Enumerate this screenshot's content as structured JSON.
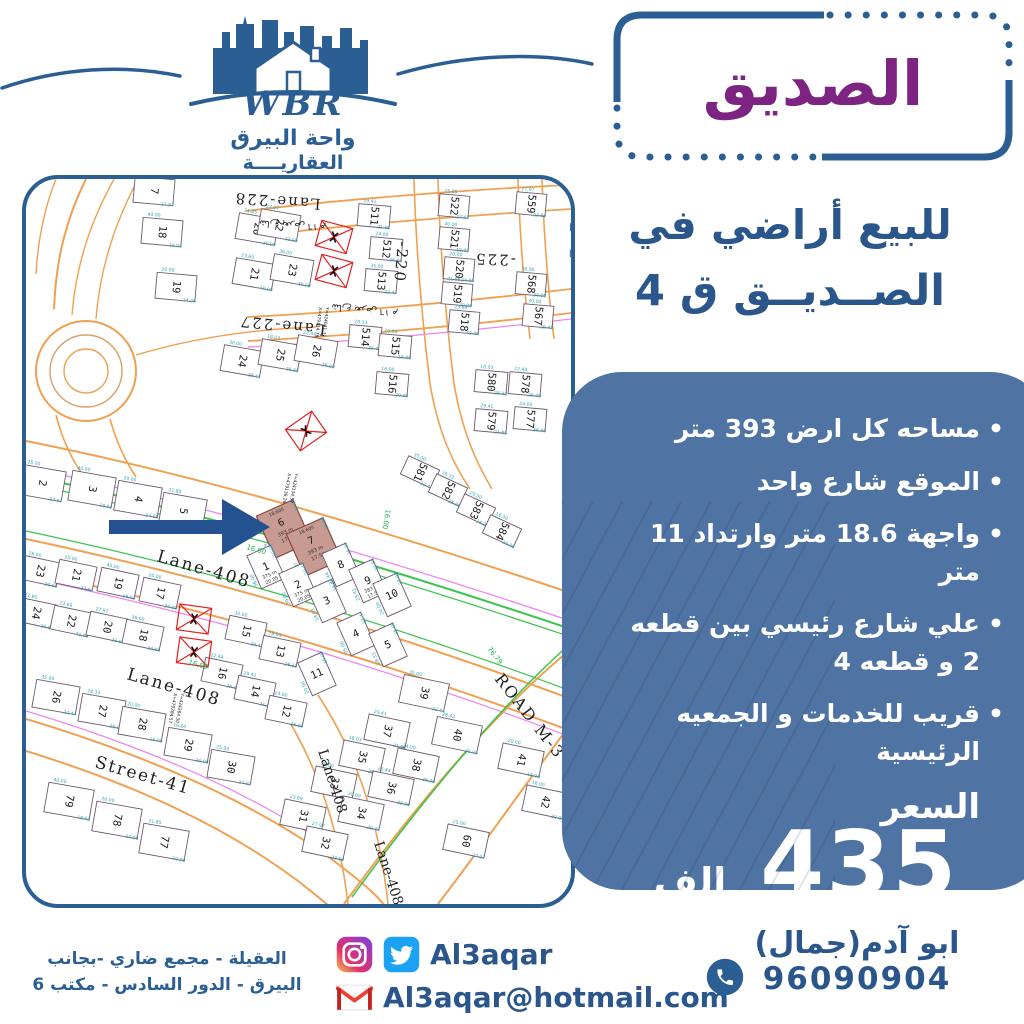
{
  "brand": {
    "name": "WBR",
    "line1": "واحة البيرق",
    "line2": "العقاريــــة"
  },
  "badge": {
    "text": "الصديق"
  },
  "headline": {
    "line1": "للبيع أراضي في",
    "line2": "الصــديــق ق 4"
  },
  "features": {
    "items": [
      "مساحه كل ارض 393 متر",
      "الموقع شارع واحد",
      "واجهة 18.6 متر وارتداد 11 متر",
      "علي شارع رئيسي بين قطعه 2 و قطعه 4",
      "قريب للخدمات و الجمعيه الرئيسية"
    ]
  },
  "price": {
    "label": "السعر",
    "amount": "435",
    "unit": "الف"
  },
  "contact": {
    "social_handle": "Al3aqar",
    "email": "Al3aqar@hotmail.com",
    "agent_name": "ابو آدم(جمال)",
    "phone": "96090904",
    "address_line1": "العقيلة - مجمع ضاري -بجانب",
    "address_line2": "البيرق - الدور السادس - مكتب 6"
  },
  "colors": {
    "blue": "#2b5f94",
    "text_blue": "#2a568c",
    "panel": "#4f73a2",
    "purple": "#7d2483",
    "highlight": "#c79b92",
    "orange": "#f0a050",
    "green": "#3bc34f",
    "magenta": "#ee82ee",
    "cyan": "#2fa3b5",
    "red": "#e02020",
    "arrow": "#24518f"
  },
  "map": {
    "watermark": "القطعه2",
    "street_labels": [
      {
        "t": "Lane-228",
        "x": 295,
        "y": 20,
        "r": 184,
        "s": 15
      },
      {
        "t": "شارع بعرض ١٦ م",
        "x": 300,
        "y": 46,
        "r": 184,
        "s": 9
      },
      {
        "t": "Lane-227",
        "x": 300,
        "y": 146,
        "r": 186,
        "s": 15
      },
      {
        "t": "شارع بعرض ١٦ م",
        "x": 372,
        "y": 132,
        "r": 186,
        "s": 9
      },
      {
        "t": "-220",
        "x": 372,
        "y": 62,
        "r": 95,
        "s": 15
      },
      {
        "t": "-225",
        "x": 490,
        "y": 76,
        "r": 182,
        "s": 15
      },
      {
        "t": "Lane-408",
        "x": 130,
        "y": 382,
        "r": 16,
        "s": 17
      },
      {
        "t": "Lane-408",
        "x": 100,
        "y": 500,
        "r": 16,
        "s": 17
      },
      {
        "t": "Street-41",
        "x": 68,
        "y": 588,
        "r": 16,
        "s": 17
      },
      {
        "t": "Lane-408",
        "x": 292,
        "y": 572,
        "r": 72,
        "s": 14
      },
      {
        "t": "Lane-408",
        "x": 348,
        "y": 664,
        "r": 72,
        "s": 14
      },
      {
        "t": "ROAD  M-3",
        "x": 468,
        "y": 500,
        "r": 52,
        "s": 16
      }
    ],
    "green_labels": [
      {
        "t": "16.00",
        "x": 220,
        "y": 370,
        "r": 16
      },
      {
        "t": "16.00",
        "x": 162,
        "y": 485,
        "r": 16
      },
      {
        "t": "16.00",
        "x": 360,
        "y": 330,
        "r": 100
      },
      {
        "t": "76.79",
        "x": 461,
        "y": 470,
        "r": 52
      }
    ],
    "coord_labels": [
      {
        "t": "X=479114.78",
        "x": 293,
        "y": 128,
        "r": 97
      },
      {
        "t": "Y=424041.31",
        "x": 300,
        "y": 128,
        "r": 97
      },
      {
        "t": "X=479136.26",
        "x": 262,
        "y": 294,
        "r": 100
      },
      {
        "t": "Y=424134.57",
        "x": 269,
        "y": 294,
        "r": 100
      },
      {
        "t": "X=479284.57",
        "x": 148,
        "y": 514,
        "r": 100
      },
      {
        "t": "Y=424264.30",
        "x": 155,
        "y": 514,
        "r": 100
      }
    ],
    "survey_marks": [
      {
        "x": 308,
        "y": 58,
        "r": 15
      },
      {
        "x": 308,
        "y": 92,
        "r": 15
      },
      {
        "x": 280,
        "y": 252,
        "r": -35
      },
      {
        "x": 168,
        "y": 440,
        "r": 8
      },
      {
        "x": 168,
        "y": 473,
        "r": 8
      }
    ],
    "highlight_info": {
      "frontage": "18.605",
      "area": "393 m",
      "depth": "17.54"
    },
    "dims": [
      "25.00",
      "40.00",
      "20.00",
      "21.85",
      "23.69",
      "27.97",
      "36.00",
      "30.00",
      "18.03",
      "22.44",
      "29.41",
      "24.00",
      "35.00",
      "28.33",
      "20.00",
      "16.00"
    ],
    "plots": [
      {
        "n": "7",
        "x": 128,
        "y": 12,
        "r": 95
      },
      {
        "n": "18",
        "x": 136,
        "y": 53,
        "r": 95
      },
      {
        "n": "19",
        "x": 150,
        "y": 108,
        "r": 95
      },
      {
        "n": "20",
        "x": 231,
        "y": 50,
        "r": 100
      },
      {
        "n": "21",
        "x": 228,
        "y": 95,
        "r": 100
      },
      {
        "n": "22",
        "x": 253,
        "y": 46,
        "r": 100
      },
      {
        "n": "23",
        "x": 266,
        "y": 91,
        "r": 100
      },
      {
        "n": "24",
        "x": 216,
        "y": 182,
        "r": 100
      },
      {
        "n": "25",
        "x": 254,
        "y": 176,
        "r": 100
      },
      {
        "n": "26",
        "x": 290,
        "y": 172,
        "r": 100
      },
      {
        "n": "511",
        "x": 348,
        "y": 37,
        "r": 95,
        "w": 22,
        "h": 32
      },
      {
        "n": "512",
        "x": 360,
        "y": 70,
        "r": 95,
        "w": 22,
        "h": 32
      },
      {
        "n": "513",
        "x": 355,
        "y": 102,
        "r": 95,
        "w": 22,
        "h": 32
      },
      {
        "n": "514",
        "x": 339,
        "y": 158,
        "r": 95,
        "w": 22,
        "h": 32
      },
      {
        "n": "515",
        "x": 369,
        "y": 167,
        "r": 95,
        "w": 22,
        "h": 32
      },
      {
        "n": "516",
        "x": 366,
        "y": 205,
        "r": 95,
        "w": 22,
        "h": 32
      },
      {
        "n": "522",
        "x": 428,
        "y": 27,
        "r": 95,
        "w": 22,
        "h": 30
      },
      {
        "n": "521",
        "x": 428,
        "y": 60,
        "r": 95,
        "w": 22,
        "h": 30
      },
      {
        "n": "520",
        "x": 433,
        "y": 90,
        "r": 95,
        "w": 22,
        "h": 30
      },
      {
        "n": "519",
        "x": 431,
        "y": 115,
        "r": 95,
        "w": 22,
        "h": 30
      },
      {
        "n": "518",
        "x": 438,
        "y": 143,
        "r": 95,
        "w": 22,
        "h": 30
      },
      {
        "n": "559",
        "x": 505,
        "y": 25,
        "r": 95,
        "w": 22,
        "h": 30
      },
      {
        "n": "568",
        "x": 505,
        "y": 105,
        "r": 95,
        "w": 22,
        "h": 30
      },
      {
        "n": "567",
        "x": 512,
        "y": 137,
        "r": 95,
        "w": 22,
        "h": 30
      },
      {
        "n": "580",
        "x": 465,
        "y": 203,
        "r": 95,
        "w": 22,
        "h": 32
      },
      {
        "n": "578",
        "x": 499,
        "y": 205,
        "r": 95,
        "w": 22,
        "h": 32
      },
      {
        "n": "579",
        "x": 465,
        "y": 242,
        "r": 95,
        "w": 22,
        "h": 32
      },
      {
        "n": "577",
        "x": 504,
        "y": 240,
        "r": 95,
        "w": 22,
        "h": 32
      },
      {
        "n": "581",
        "x": 394,
        "y": 293,
        "r": 115,
        "w": 20,
        "h": 34
      },
      {
        "n": "582",
        "x": 422,
        "y": 311,
        "r": 115,
        "w": 20,
        "h": 34
      },
      {
        "n": "583",
        "x": 450,
        "y": 331,
        "r": 115,
        "w": 20,
        "h": 34
      },
      {
        "n": "584",
        "x": 476,
        "y": 352,
        "r": 115,
        "w": 20,
        "h": 34
      },
      {
        "n": "2",
        "x": 16,
        "y": 304,
        "r": 100,
        "w": 30,
        "h": 44
      },
      {
        "n": "3",
        "x": 66,
        "y": 310,
        "r": 100,
        "w": 30,
        "h": 44
      },
      {
        "n": "4",
        "x": 112,
        "y": 320,
        "r": 100,
        "w": 30,
        "h": 44
      },
      {
        "n": "5",
        "x": 157,
        "y": 332,
        "r": 100,
        "w": 30,
        "h": 44
      },
      {
        "n": "6",
        "x": 258,
        "y": 350,
        "r": -24,
        "w": 40,
        "h": 46,
        "hl": true
      },
      {
        "n": "7",
        "x": 288,
        "y": 368,
        "r": -24,
        "w": 40,
        "h": 46,
        "hl": true
      },
      {
        "n": "1",
        "x": 240,
        "y": 388,
        "r": -24,
        "w": 26,
        "h": 36,
        "sub": [
          "375 m",
          "20.05"
        ]
      },
      {
        "n": "2",
        "x": 272,
        "y": 406,
        "r": -24,
        "w": 26,
        "h": 36,
        "sub": [
          "375 m",
          "20.05"
        ]
      },
      {
        "n": "3",
        "x": 301,
        "y": 422,
        "r": -24,
        "w": 26,
        "h": 36
      },
      {
        "n": "8",
        "x": 315,
        "y": 386,
        "r": -24,
        "w": 26,
        "h": 36
      },
      {
        "n": "9",
        "x": 342,
        "y": 402,
        "r": -24,
        "w": 26,
        "h": 36,
        "sub": [
          "383 m",
          "17.58"
        ]
      },
      {
        "n": "10",
        "x": 366,
        "y": 416,
        "r": -24,
        "w": 26,
        "h": 36
      },
      {
        "n": "4",
        "x": 330,
        "y": 455,
        "r": -24,
        "w": 26,
        "h": 36
      },
      {
        "n": "5",
        "x": 362,
        "y": 466,
        "r": -24,
        "w": 26,
        "h": 36
      },
      {
        "n": "11",
        "x": 291,
        "y": 495,
        "r": -24,
        "w": 26,
        "h": 36
      },
      {
        "n": "23",
        "x": 14,
        "y": 392,
        "r": 102,
        "w": 24,
        "h": 38
      },
      {
        "n": "21",
        "x": 50,
        "y": 396,
        "r": 102,
        "w": 24,
        "h": 38
      },
      {
        "n": "19",
        "x": 92,
        "y": 404,
        "r": 102,
        "w": 24,
        "h": 38
      },
      {
        "n": "17",
        "x": 134,
        "y": 414,
        "r": 102,
        "w": 24,
        "h": 38
      },
      {
        "n": "24",
        "x": 10,
        "y": 434,
        "r": 102,
        "w": 24,
        "h": 38
      },
      {
        "n": "22",
        "x": 45,
        "y": 442,
        "r": 102,
        "w": 24,
        "h": 38
      },
      {
        "n": "20",
        "x": 81,
        "y": 448,
        "r": 102,
        "w": 24,
        "h": 38
      },
      {
        "n": "18",
        "x": 117,
        "y": 456,
        "r": 102,
        "w": 24,
        "h": 38
      },
      {
        "n": "15",
        "x": 220,
        "y": 452,
        "r": 102,
        "w": 24,
        "h": 38
      },
      {
        "n": "13",
        "x": 254,
        "y": 472,
        "r": 102,
        "w": 24,
        "h": 38
      },
      {
        "n": "16",
        "x": 196,
        "y": 494,
        "r": 102,
        "w": 24,
        "h": 38
      },
      {
        "n": "14",
        "x": 229,
        "y": 512,
        "r": 102,
        "w": 24,
        "h": 38
      },
      {
        "n": "12",
        "x": 260,
        "y": 532,
        "r": 102,
        "w": 24,
        "h": 38
      },
      {
        "n": "26",
        "x": 30,
        "y": 518,
        "r": 100,
        "w": 28,
        "h": 44
      },
      {
        "n": "27",
        "x": 76,
        "y": 532,
        "r": 100,
        "w": 28,
        "h": 44
      },
      {
        "n": "28",
        "x": 116,
        "y": 545,
        "r": 100,
        "w": 28,
        "h": 44
      },
      {
        "n": "29",
        "x": 162,
        "y": 566,
        "r": 100,
        "w": 28,
        "h": 44
      },
      {
        "n": "30",
        "x": 205,
        "y": 588,
        "r": 100,
        "w": 28,
        "h": 44
      },
      {
        "n": "79",
        "x": 43,
        "y": 622,
        "r": 100,
        "w": 30,
        "h": 46
      },
      {
        "n": "78",
        "x": 91,
        "y": 641,
        "r": 100,
        "w": 30,
        "h": 46
      },
      {
        "n": "77",
        "x": 138,
        "y": 663,
        "r": 100,
        "w": 30,
        "h": 46
      },
      {
        "n": "31",
        "x": 277,
        "y": 637,
        "r": 102,
        "w": 26,
        "h": 42
      },
      {
        "n": "32",
        "x": 299,
        "y": 664,
        "r": 102,
        "w": 26,
        "h": 42
      },
      {
        "n": "33",
        "x": 308,
        "y": 604,
        "r": 102,
        "w": 26,
        "h": 42
      },
      {
        "n": "34",
        "x": 335,
        "y": 634,
        "r": 102,
        "w": 26,
        "h": 42
      },
      {
        "n": "35",
        "x": 336,
        "y": 578,
        "r": 102,
        "w": 26,
        "h": 42
      },
      {
        "n": "36",
        "x": 365,
        "y": 609,
        "r": 102,
        "w": 26,
        "h": 42
      },
      {
        "n": "37",
        "x": 361,
        "y": 552,
        "r": 102,
        "w": 26,
        "h": 42
      },
      {
        "n": "38",
        "x": 390,
        "y": 586,
        "r": 102,
        "w": 26,
        "h": 42
      },
      {
        "n": "39",
        "x": 398,
        "y": 514,
        "r": 102,
        "w": 28,
        "h": 46
      },
      {
        "n": "40",
        "x": 431,
        "y": 556,
        "r": 102,
        "w": 28,
        "h": 46
      },
      {
        "n": "41",
        "x": 495,
        "y": 581,
        "r": 102,
        "w": 26,
        "h": 42
      },
      {
        "n": "42",
        "x": 519,
        "y": 623,
        "r": 102,
        "w": 26,
        "h": 42
      },
      {
        "n": "60",
        "x": 440,
        "y": 662,
        "r": 102,
        "w": 26,
        "h": 42
      }
    ]
  }
}
